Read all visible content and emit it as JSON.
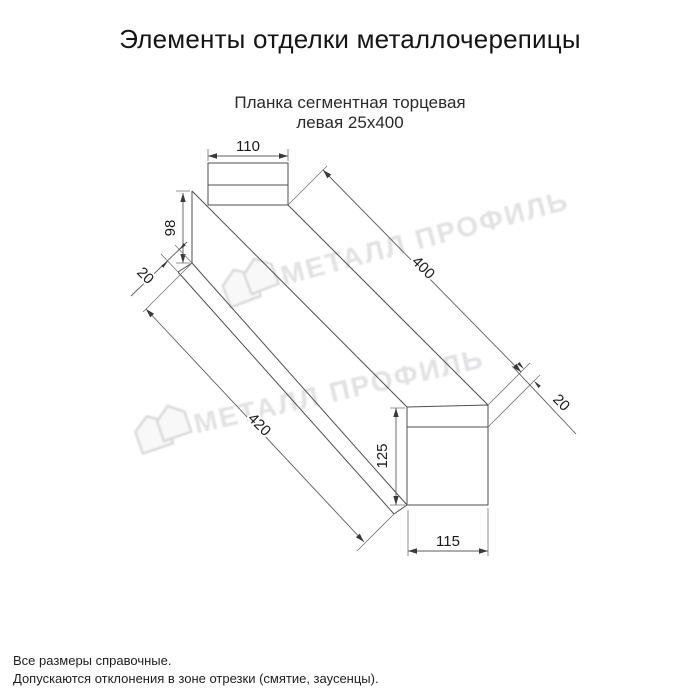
{
  "page": {
    "title": "Элементы отделки металлочерепицы",
    "product_line1": "Планка сегментная торцевая",
    "product_line2": "левая 25х400",
    "note_line1": "Все размеры справочные.",
    "note_line2": "Допускаются отклонения в зоне отрезки (смятие, заусенцы)."
  },
  "drawing": {
    "kind": "technical-drawing-isometric",
    "part_name": "Планка сегментная торцевая левая",
    "size_label": "25х400",
    "dims": {
      "top_flange_width": "110",
      "left_end_height": "98",
      "bottom_hem": "20",
      "top_edge_length": "400",
      "bottom_edge_length": "420",
      "right_end_fold": "20",
      "right_end_height": "125",
      "right_end_width": "115"
    },
    "line_color": "#4f4f4f",
    "dim_text_color": "#1b1b1b"
  },
  "watermark": {
    "text": "МЕТАЛЛ ПРОФИЛЬ",
    "logo": "metal-profile-double-house-logo",
    "color": "#e2e2e4"
  }
}
